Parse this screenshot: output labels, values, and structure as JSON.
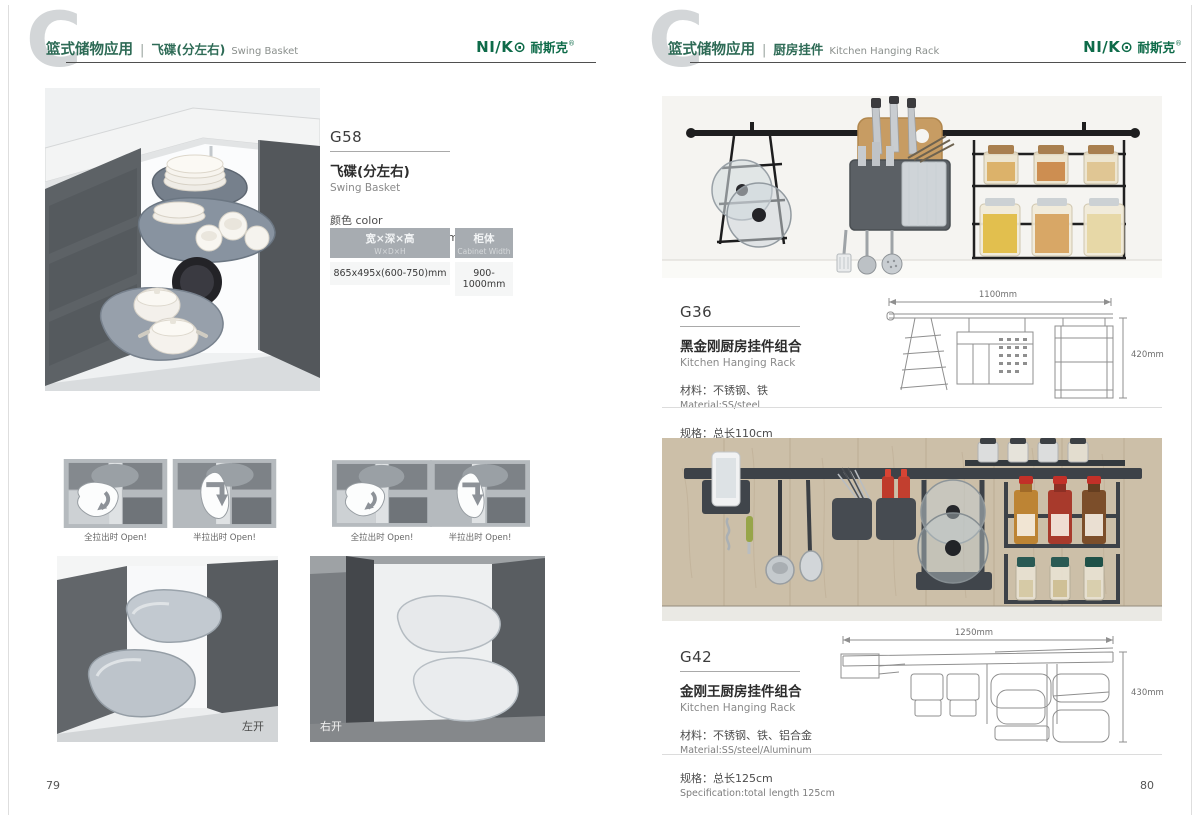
{
  "colors": {
    "brand_green": "#0e6b49",
    "title_green": "#2e6b56",
    "table_header_bg": "#a7acb1",
    "watermark_gray": "#d3d6d8"
  },
  "brand": {
    "logo_en": "NI/K⊙",
    "logo_cn": "耐斯克",
    "logo_reg": "®"
  },
  "watermark_letter": "C",
  "header_separator": "|",
  "page_left": {
    "page_number": "79",
    "header": {
      "category": "篮式储物应用",
      "title_cn": "飞碟(分左右)",
      "title_en": "Swing Basket"
    },
    "product": {
      "model": "G58",
      "name_cn": "飞碟(分左右)",
      "name_en": "Swing Basket",
      "color_label": "颜色 color",
      "color_value": "灰色、镀铬 Grey/ Chrome",
      "table": {
        "col1_header_cn": "宽×深×高",
        "col1_header_en": "W×D×H",
        "col1_value": "865x495x(600-750)mm",
        "col2_header_cn": "柜体",
        "col2_header_en": "Cabinet Width",
        "col2_value": "900-1000mm"
      }
    },
    "captions": {
      "c1": "全拉出时 Open!",
      "c2": "半拉出时 Open!",
      "c3": "全拉出时 Open!",
      "c4": "半拉出时 Open!"
    },
    "photo_labels": {
      "left": "左开",
      "right": "右开"
    }
  },
  "page_right": {
    "page_number": "80",
    "header": {
      "category": "篮式储物应用",
      "title_cn": "厨房挂件",
      "title_en": "Kitchen Hanging Rack"
    },
    "g36": {
      "model": "G36",
      "name_cn": "黑金刚厨房挂件组合",
      "name_en": "Kitchen Hanging Rack",
      "material_cn": "材料：不锈钢、铁",
      "material_en": "Material:SS/steel",
      "spec_cn": "规格：总长110cm",
      "spec_en": "Specification:total length 100cm",
      "dim_w": "1100mm",
      "dim_h": "420mm"
    },
    "g42": {
      "model": "G42",
      "name_cn": "金刚王厨房挂件组合",
      "name_en": "Kitchen Hanging Rack",
      "material_cn": "材料：不锈钢、铁、铝合金",
      "material_en": "Material:SS/steel/Aluminum",
      "spec_cn": "规格：总长125cm",
      "spec_en": "Specification:total length 125cm",
      "dim_w": "1250mm",
      "dim_h": "430mm"
    }
  }
}
